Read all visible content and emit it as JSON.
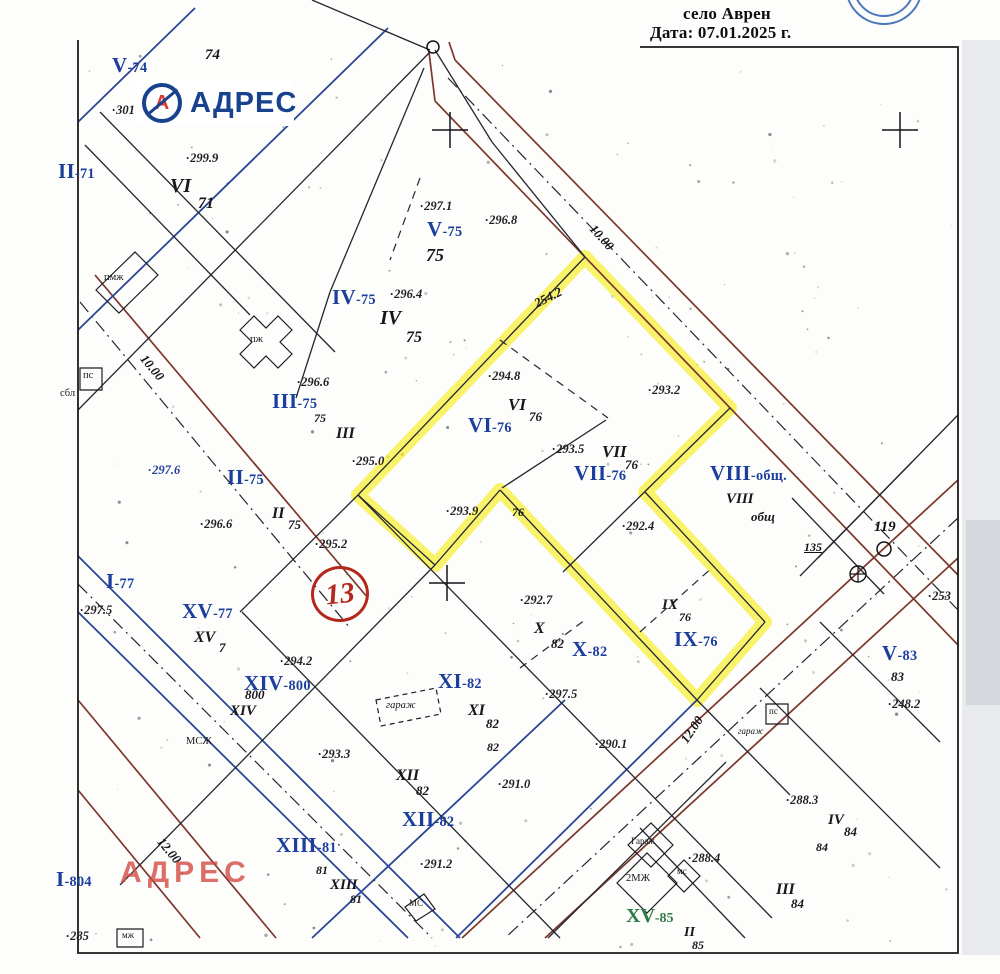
{
  "header": {
    "line1": "село Аврен",
    "line2": "Дата: 07.01.2025 г."
  },
  "logo": {
    "text": "АДРЕС",
    "icon": "circled-a-logo"
  },
  "watermark": {
    "text": "АДРЕС"
  },
  "district": {
    "number": "13"
  },
  "colors": {
    "highlight": "#f6ee33",
    "roads": "#7c372c",
    "ink_blue": "#2c4697",
    "ink_black": "#23262e",
    "label_blue": "#1c3f9d",
    "label_green": "#2e7b44",
    "red": "#b5271d",
    "logo_blue": "#18418e",
    "logo_red": "#d93a36",
    "watermark_red": "#d24840",
    "stamp_blue": "#2e5fb3"
  },
  "labels": {
    "parcel_blue": [
      {
        "num": "V",
        "suf": "-74",
        "x": 112,
        "y": 54
      },
      {
        "num": "II",
        "suf": "-71",
        "x": 58,
        "y": 160
      },
      {
        "num": "V",
        "suf": "-75",
        "x": 427,
        "y": 218
      },
      {
        "num": "IV",
        "suf": "-75",
        "x": 332,
        "y": 286
      },
      {
        "num": "III",
        "suf": "-75",
        "x": 272,
        "y": 390
      },
      {
        "num": "II",
        "suf": "-75",
        "x": 227,
        "y": 466
      },
      {
        "num": "VI",
        "suf": "-76",
        "x": 468,
        "y": 414
      },
      {
        "num": "VII",
        "suf": "-76",
        "x": 574,
        "y": 462
      },
      {
        "num": "VIII",
        "suf": "-общ.",
        "x": 710,
        "y": 462
      },
      {
        "num": "I",
        "suf": "-77",
        "x": 106,
        "y": 570
      },
      {
        "num": "XV",
        "suf": "-77",
        "x": 182,
        "y": 600
      },
      {
        "num": "XIV",
        "suf": "-800",
        "x": 244,
        "y": 672
      },
      {
        "num": "XI",
        "suf": "-82",
        "x": 438,
        "y": 670
      },
      {
        "num": "X",
        "suf": "-82",
        "x": 572,
        "y": 638
      },
      {
        "num": "IX",
        "suf": "-76",
        "x": 674,
        "y": 628
      },
      {
        "num": "XII",
        "suf": "-82",
        "x": 402,
        "y": 808
      },
      {
        "num": "XIII",
        "suf": "-81",
        "x": 276,
        "y": 834
      },
      {
        "num": "I",
        "suf": "-804",
        "x": 56,
        "y": 868
      },
      {
        "num": "V",
        "suf": "-83",
        "x": 882,
        "y": 642
      }
    ],
    "parcel_green": [
      {
        "num": "XV",
        "suf": "-85",
        "x": 626,
        "y": 906
      }
    ],
    "handwritten": [
      {
        "t": "74",
        "x": 205,
        "y": 48,
        "fs": 15
      },
      {
        "t": "VI",
        "x": 170,
        "y": 176,
        "fs": 20
      },
      {
        "t": "71",
        "x": 198,
        "y": 196,
        "fs": 16
      },
      {
        "t": "75",
        "x": 426,
        "y": 246,
        "fs": 18
      },
      {
        "t": "IV",
        "x": 380,
        "y": 308,
        "fs": 20
      },
      {
        "t": "75",
        "x": 406,
        "y": 330,
        "fs": 16
      },
      {
        "t": "75",
        "x": 314,
        "y": 412,
        "fs": 12
      },
      {
        "t": "III",
        "x": 336,
        "y": 426,
        "fs": 16
      },
      {
        "t": "II",
        "x": 272,
        "y": 506,
        "fs": 16
      },
      {
        "t": "75",
        "x": 288,
        "y": 518,
        "fs": 13
      },
      {
        "t": "VI",
        "x": 508,
        "y": 396,
        "fs": 17
      },
      {
        "t": "76",
        "x": 529,
        "y": 410,
        "fs": 13
      },
      {
        "t": "VII",
        "x": 602,
        "y": 443,
        "fs": 17
      },
      {
        "t": "76",
        "x": 625,
        "y": 458,
        "fs": 13
      },
      {
        "t": "VIII",
        "x": 726,
        "y": 492,
        "fs": 15
      },
      {
        "t": "общ",
        "x": 751,
        "y": 510,
        "fs": 13
      },
      {
        "t": "XV",
        "x": 194,
        "y": 630,
        "fs": 16
      },
      {
        "t": "7",
        "x": 219,
        "y": 641,
        "fs": 13
      },
      {
        "t": "800",
        "x": 245,
        "y": 688,
        "fs": 13
      },
      {
        "t": "XIV",
        "x": 230,
        "y": 704,
        "fs": 15
      },
      {
        "t": "X",
        "x": 534,
        "y": 621,
        "fs": 16
      },
      {
        "t": "82",
        "x": 551,
        "y": 637,
        "fs": 13
      },
      {
        "t": "IX",
        "x": 662,
        "y": 598,
        "fs": 15
      },
      {
        "t": "76",
        "x": 679,
        "y": 611,
        "fs": 12
      },
      {
        "t": "XI",
        "x": 468,
        "y": 703,
        "fs": 16
      },
      {
        "t": "82",
        "x": 486,
        "y": 717,
        "fs": 13
      },
      {
        "t": "82",
        "x": 487,
        "y": 741,
        "fs": 12
      },
      {
        "t": "XII",
        "x": 396,
        "y": 768,
        "fs": 16
      },
      {
        "t": "82",
        "x": 416,
        "y": 784,
        "fs": 13
      },
      {
        "t": "81",
        "x": 316,
        "y": 864,
        "fs": 12
      },
      {
        "t": "XIII",
        "x": 330,
        "y": 878,
        "fs": 15
      },
      {
        "t": "81",
        "x": 350,
        "y": 893,
        "fs": 12
      },
      {
        "t": "IV",
        "x": 828,
        "y": 813,
        "fs": 15
      },
      {
        "t": "84",
        "x": 844,
        "y": 825,
        "fs": 13
      },
      {
        "t": "84",
        "x": 816,
        "y": 841,
        "fs": 12
      },
      {
        "t": "III",
        "x": 776,
        "y": 882,
        "fs": 16
      },
      {
        "t": "84",
        "x": 791,
        "y": 897,
        "fs": 13
      },
      {
        "t": "II",
        "x": 684,
        "y": 926,
        "fs": 14
      },
      {
        "t": "85",
        "x": 692,
        "y": 939,
        "fs": 12
      },
      {
        "t": "83",
        "x": 891,
        "y": 670,
        "fs": 13
      },
      {
        "t": "76",
        "x": 512,
        "y": 506,
        "fs": 12
      }
    ],
    "elevations": [
      {
        "t": "299.9",
        "x": 186,
        "y": 152
      },
      {
        "t": "301",
        "x": 112,
        "y": 104
      },
      {
        "t": "297.1",
        "x": 420,
        "y": 200
      },
      {
        "t": "296.8",
        "x": 485,
        "y": 214
      },
      {
        "t": "296.4",
        "x": 390,
        "y": 288
      },
      {
        "t": "296.6",
        "x": 297,
        "y": 376
      },
      {
        "t": "297.6",
        "x": 148,
        "y": 464,
        "blue": true
      },
      {
        "t": "296.6",
        "x": 200,
        "y": 518
      },
      {
        "t": "295.0",
        "x": 352,
        "y": 455
      },
      {
        "t": "295.2",
        "x": 315,
        "y": 538
      },
      {
        "t": "294.8",
        "x": 488,
        "y": 370
      },
      {
        "t": "293.2",
        "x": 648,
        "y": 384
      },
      {
        "t": "293.5",
        "x": 552,
        "y": 443
      },
      {
        "t": "292.4",
        "x": 622,
        "y": 520
      },
      {
        "t": "293.9",
        "x": 446,
        "y": 505
      },
      {
        "t": "292.7",
        "x": 520,
        "y": 594
      },
      {
        "t": "297.5",
        "x": 545,
        "y": 688
      },
      {
        "t": "290.1",
        "x": 595,
        "y": 738
      },
      {
        "t": "294.2",
        "x": 280,
        "y": 655
      },
      {
        "t": "297.5",
        "x": 80,
        "y": 604
      },
      {
        "t": "293.3",
        "x": 318,
        "y": 748
      },
      {
        "t": "291.0",
        "x": 498,
        "y": 778
      },
      {
        "t": "291.2",
        "x": 420,
        "y": 858
      },
      {
        "t": "288.4",
        "x": 688,
        "y": 852
      },
      {
        "t": "288.3",
        "x": 786,
        "y": 794
      },
      {
        "t": "248.2",
        "x": 888,
        "y": 698
      },
      {
        "t": "253",
        "x": 928,
        "y": 590
      },
      {
        "t": "285",
        "x": 66,
        "y": 930
      }
    ],
    "road_widths": [
      {
        "t": "10.00",
        "x": 597,
        "y": 222,
        "r": 48
      },
      {
        "t": "10.00",
        "x": 148,
        "y": 352,
        "r": 50
      },
      {
        "t": "12.00",
        "x": 165,
        "y": 835,
        "r": 50
      },
      {
        "t": "12.00",
        "x": 678,
        "y": 738,
        "r": -56
      },
      {
        "t": "254.2",
        "x": 532,
        "y": 298,
        "r": -27
      }
    ],
    "points": [
      {
        "t": "119",
        "x": 874,
        "y": 520,
        "fs": 15
      },
      {
        "t": "135",
        "x": 804,
        "y": 541,
        "fs": 12,
        "ul": true
      }
    ],
    "buildings": [
      {
        "t": "пмж",
        "x": 104,
        "y": 272
      },
      {
        "t": "пж",
        "x": 250,
        "y": 334
      },
      {
        "t": "пс",
        "x": 83,
        "y": 370
      },
      {
        "t": "сбл",
        "x": 60,
        "y": 388
      },
      {
        "t": "МСЖ",
        "x": 186,
        "y": 736
      },
      {
        "t": "гараж",
        "x": 386,
        "y": 700,
        "i": true
      },
      {
        "t": "Гараж",
        "x": 631,
        "y": 837,
        "fs": 9
      },
      {
        "t": "2МЖ",
        "x": 626,
        "y": 873
      },
      {
        "t": "мс",
        "x": 677,
        "y": 867,
        "fs": 9
      },
      {
        "t": "МС",
        "x": 409,
        "y": 899,
        "fs": 9
      },
      {
        "t": "мж",
        "x": 122,
        "y": 931,
        "fs": 9
      },
      {
        "t": "пс",
        "x": 769,
        "y": 707,
        "fs": 9
      },
      {
        "t": "гараж",
        "x": 738,
        "y": 727,
        "i": true,
        "fs": 9
      }
    ]
  },
  "geometry": {
    "frame": "M 640 47 H 958 V 953 H 78 V 40",
    "yellow": "585,257 730,408 645,492 765,622 697,700 500,490 435,565 358,495",
    "strips": [
      {
        "x": 962,
        "y": 40,
        "w": 38,
        "h": 915,
        "f": "#e8eaed"
      },
      {
        "x": 966,
        "y": 520,
        "w": 34,
        "h": 185,
        "f": "#d4d7db"
      }
    ],
    "brown": [
      [
        455,
        60,
        958,
        575
      ],
      [
        435,
        101,
        958,
        645
      ],
      [
        958,
        480,
        462,
        938
      ],
      [
        958,
        558,
        545,
        938
      ],
      [
        95,
        275,
        368,
        598
      ],
      [
        78,
        790,
        200,
        938
      ],
      [
        78,
        700,
        276,
        938
      ],
      [
        435,
        101,
        429,
        52
      ],
      [
        455,
        60,
        449,
        42
      ]
    ],
    "blue": [
      [
        388,
        28,
        78,
        330
      ],
      [
        195,
        8,
        78,
        122
      ],
      [
        78,
        556,
        460,
        938
      ],
      [
        78,
        612,
        408,
        938
      ],
      [
        565,
        700,
        312,
        938
      ],
      [
        697,
        700,
        456,
        938
      ]
    ],
    "black": [
      [
        430,
        52,
        78,
        410
      ],
      [
        100,
        112,
        335,
        352
      ],
      [
        312,
        0,
        430,
        50
      ],
      [
        435,
        50,
        492,
        142
      ],
      [
        492,
        142,
        585,
        257
      ],
      [
        424,
        68,
        330,
        292
      ],
      [
        330,
        292,
        296,
        398
      ],
      [
        85,
        145,
        250,
        315
      ],
      [
        585,
        257,
        358,
        495
      ],
      [
        730,
        408,
        563,
        572
      ],
      [
        645,
        492,
        765,
        622
      ],
      [
        765,
        622,
        697,
        700
      ],
      [
        500,
        490,
        697,
        700
      ],
      [
        500,
        490,
        435,
        565
      ],
      [
        435,
        565,
        358,
        495
      ],
      [
        358,
        495,
        240,
        612
      ],
      [
        435,
        565,
        120,
        885
      ],
      [
        358,
        495,
        772,
        918
      ],
      [
        242,
        612,
        560,
        938
      ],
      [
        606,
        420,
        502,
        488
      ],
      [
        697,
        700,
        790,
        795
      ],
      [
        548,
        938,
        726,
        762
      ],
      [
        640,
        828,
        745,
        938
      ],
      [
        760,
        688,
        940,
        868
      ],
      [
        820,
        622,
        940,
        742
      ],
      [
        958,
        415,
        818,
        558
      ],
      [
        792,
        498,
        884,
        594
      ],
      [
        912,
        462,
        800,
        576
      ]
    ],
    "dash": [
      [
        500,
        340,
        608,
        418
      ],
      [
        520,
        668,
        585,
        620
      ],
      [
        640,
        632,
        714,
        566
      ],
      [
        420,
        178,
        390,
        260
      ]
    ],
    "dashdot": [
      [
        448,
        78,
        958,
        610
      ],
      [
        958,
        518,
        505,
        938
      ],
      [
        80,
        302,
        350,
        628
      ],
      [
        78,
        584,
        432,
        938
      ]
    ],
    "buildings_poly": [
      {
        "pts": "96,290 135,252 158,275 119,313"
      },
      {
        "pts": "240,330 254,316 266,328 278,316 292,330 280,342 292,354 278,368 266,356 254,368 240,354 252,342"
      },
      {
        "pts": "80,368 102,368 102,390 80,390"
      },
      {
        "pts": "766,704 788,704 788,724 766,724"
      },
      {
        "pts": "376,700 436,688 441,714 381,726",
        "dashed": true
      },
      {
        "pts": "628,845 651,823 673,845 651,867"
      },
      {
        "pts": "617,883 647,853 677,883 647,913"
      },
      {
        "pts": "668,876 684,860 700,876 684,892"
      },
      {
        "pts": "405,907 424,894 435,909 416,921"
      },
      {
        "pts": "117,929 143,929 143,947 117,947"
      }
    ],
    "crosses": [
      [
        450,
        130
      ],
      [
        900,
        130
      ],
      [
        447,
        583
      ]
    ],
    "rings": [
      {
        "cx": 433,
        "cy": 47,
        "r": 6
      },
      {
        "cx": 884,
        "cy": 549,
        "r": 7
      }
    ],
    "oplus": {
      "cx": 858,
      "cy": 574,
      "r": 8
    },
    "stamp": {
      "cx": 884,
      "cy": -14,
      "r1": 30,
      "r2": 38
    }
  }
}
